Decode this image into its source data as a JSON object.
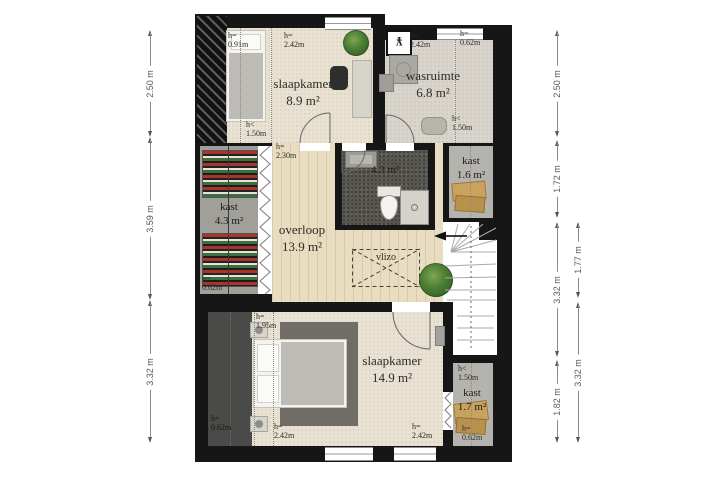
{
  "rooms": {
    "slaapkamer1": {
      "name": "slaapkamer",
      "area": "8.9 m²"
    },
    "wasruimte": {
      "name": "wasruimte",
      "area": "6.8 m²"
    },
    "badkamer": {
      "area": "4.3 m²"
    },
    "kast_left": {
      "name": "kast",
      "area": "4.3 m²"
    },
    "kast_right": {
      "name": "kast",
      "area": "1.6 m²"
    },
    "overloop": {
      "name": "overloop",
      "area": "13.9 m²"
    },
    "slaapkamer2": {
      "name": "slaapkamer",
      "area": "14.9 m²"
    },
    "kast_bottom": {
      "name": "kast",
      "area": "1.7 m²"
    }
  },
  "labels": {
    "vlizo": "vlizo",
    "mv_symbol": "¥"
  },
  "heights": [
    "h=\n0.91m",
    "h=\n2.42m",
    "h<\n1.50m",
    "h=\n2.42m",
    "h=\n0.62m",
    "h<\n1.50m",
    "h=\n2.30m",
    "h=\n0.62m",
    "h=\n1.95m",
    "h=\n0.62m",
    "h=\n2.42m",
    "h=\n2.42m",
    "h<\n1.50m",
    "h=\n0.62m"
  ],
  "dimensions": {
    "left": [
      "2.50 m",
      "3.59 m",
      "3.32 m"
    ],
    "right_inner": [
      "2.50 m",
      "1.72 m",
      "3.32 m",
      "1.82 m"
    ],
    "right_outer": [
      "1.77 m",
      "3.32 m"
    ]
  },
  "colors": {
    "wall": "#161616",
    "carpet": "#e9e1d2",
    "wood": "#e8ddc1",
    "bath_floor": "#57554f",
    "closet": "#a19f99",
    "accent_plant": "#4a7c33"
  }
}
